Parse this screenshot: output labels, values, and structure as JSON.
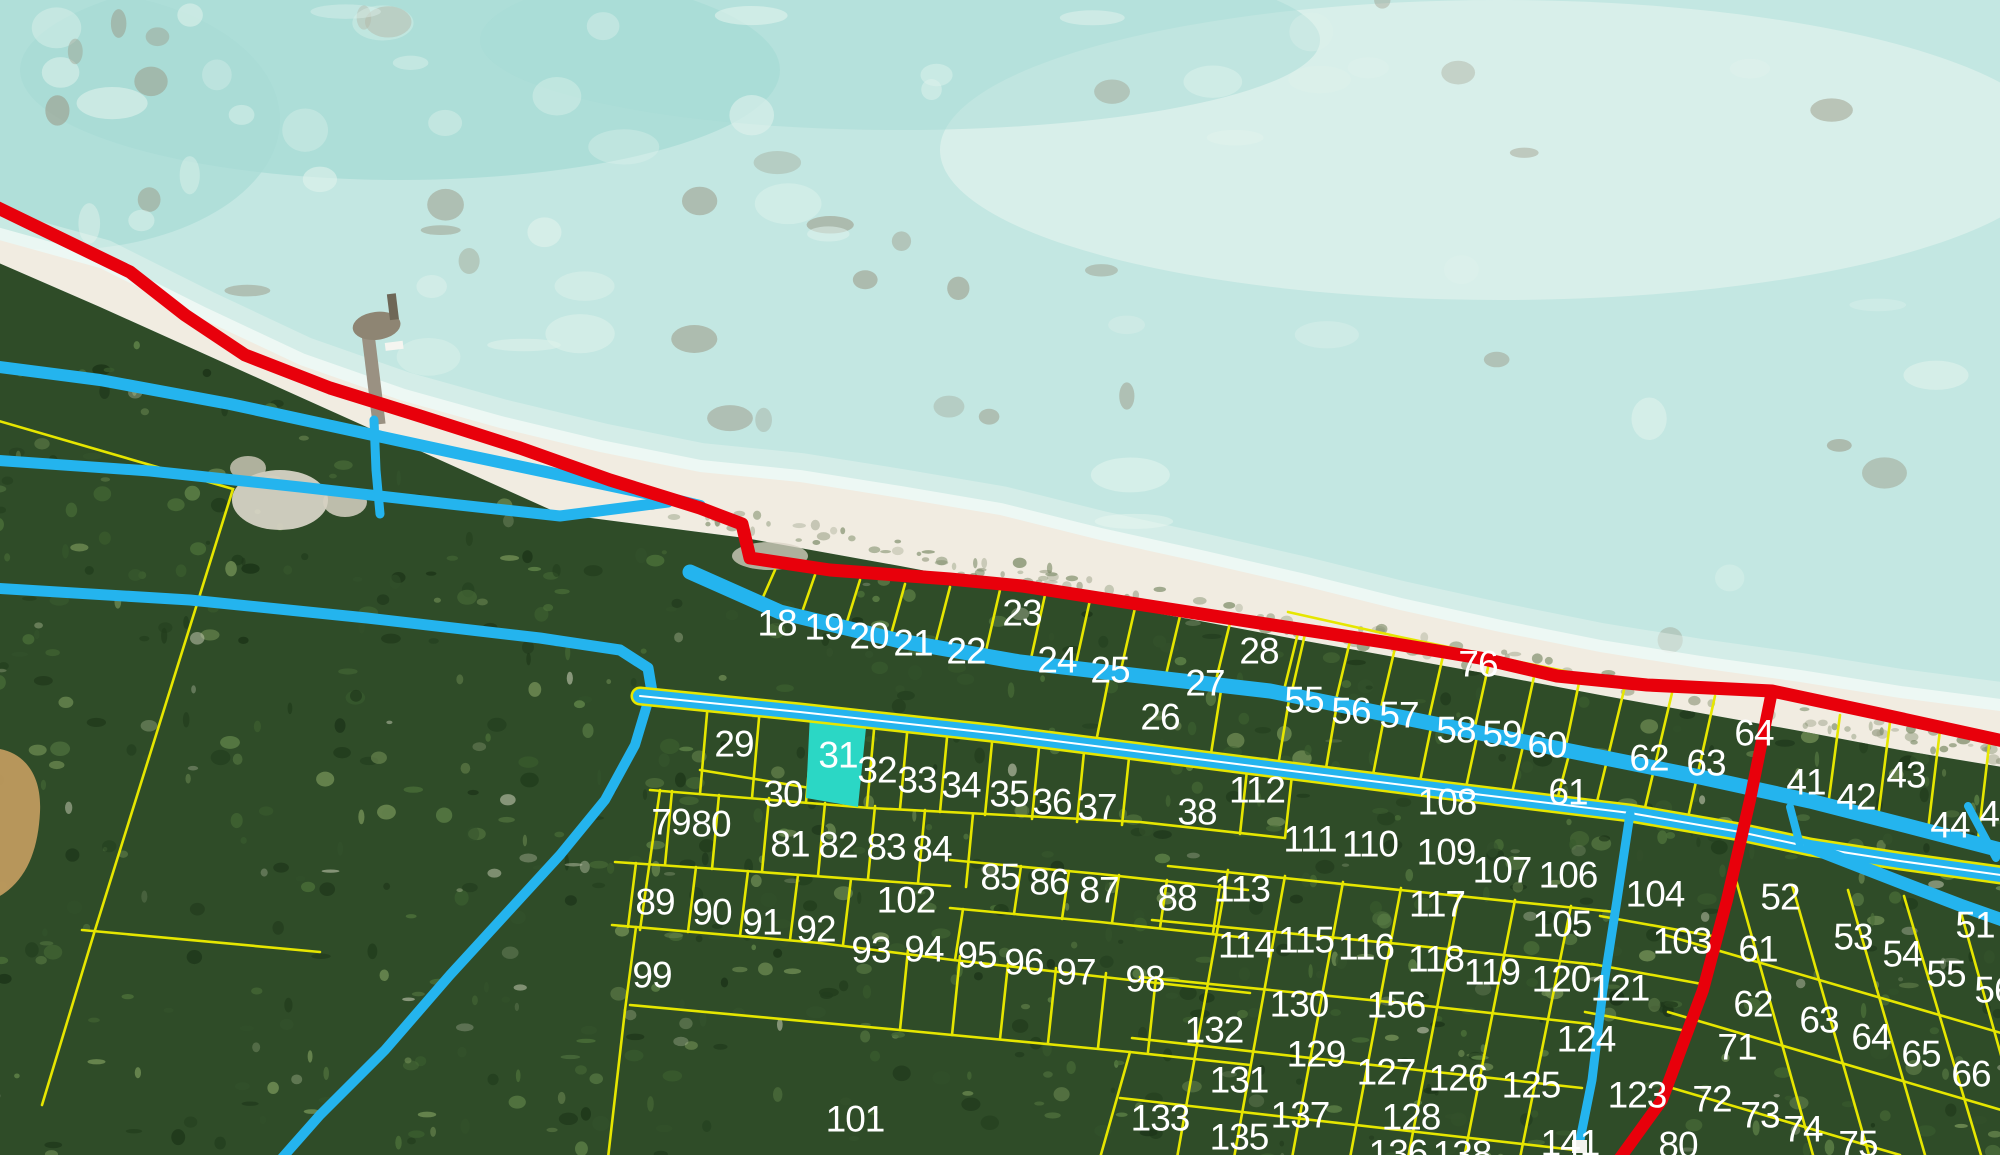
{
  "map": {
    "type": "aerial-parcel-cadastral-map",
    "colors": {
      "water": "#c3e7e2",
      "water_deep": "#a8dcd6",
      "water_light": "#e9f5f1",
      "sand": "#f1ece1",
      "land": "#2f4c28",
      "pond": "#bf9a5e",
      "road_red": "#e8000b",
      "road_cyan": "#24b4ee",
      "parcel_line_yellow": "#e6e600",
      "road_centerline": "#ffffff",
      "label_text": "#ffffff",
      "highlight_fill": "#2bd7c5"
    },
    "selected_parcel": {
      "label": "31",
      "points": "810,713 867,718 858,807 806,798"
    },
    "label_font_size": 37,
    "parcel_labels": [
      {
        "t": "18",
        "x": 777,
        "y": 622
      },
      {
        "t": "19",
        "x": 824,
        "y": 626
      },
      {
        "t": "20",
        "x": 869,
        "y": 635
      },
      {
        "t": "21",
        "x": 913,
        "y": 642
      },
      {
        "t": "22",
        "x": 966,
        "y": 650
      },
      {
        "t": "23",
        "x": 1022,
        "y": 612
      },
      {
        "t": "24",
        "x": 1057,
        "y": 659
      },
      {
        "t": "25",
        "x": 1110,
        "y": 669
      },
      {
        "t": "26",
        "x": 1160,
        "y": 716
      },
      {
        "t": "27",
        "x": 1205,
        "y": 682
      },
      {
        "t": "28",
        "x": 1259,
        "y": 650
      },
      {
        "t": "76",
        "x": 1478,
        "y": 663
      },
      {
        "t": "55",
        "x": 1304,
        "y": 699
      },
      {
        "t": "56",
        "x": 1351,
        "y": 710
      },
      {
        "t": "57",
        "x": 1399,
        "y": 714
      },
      {
        "t": "58",
        "x": 1456,
        "y": 729
      },
      {
        "t": "59",
        "x": 1502,
        "y": 733
      },
      {
        "t": "60",
        "x": 1547,
        "y": 744
      },
      {
        "t": "61",
        "x": 1568,
        "y": 791
      },
      {
        "t": "62",
        "x": 1649,
        "y": 757
      },
      {
        "t": "63",
        "x": 1706,
        "y": 762
      },
      {
        "t": "64",
        "x": 1754,
        "y": 732
      },
      {
        "t": "41",
        "x": 1806,
        "y": 781
      },
      {
        "t": "42",
        "x": 1856,
        "y": 796
      },
      {
        "t": "43",
        "x": 1906,
        "y": 774
      },
      {
        "t": "44",
        "x": 1950,
        "y": 824
      },
      {
        "t": "45",
        "x": 1999,
        "y": 813
      },
      {
        "t": "29",
        "x": 734,
        "y": 743
      },
      {
        "t": "30",
        "x": 783,
        "y": 793
      },
      {
        "t": "31",
        "x": 838,
        "y": 754
      },
      {
        "t": "32",
        "x": 877,
        "y": 769
      },
      {
        "t": "33",
        "x": 917,
        "y": 779
      },
      {
        "t": "34",
        "x": 961,
        "y": 784
      },
      {
        "t": "35",
        "x": 1009,
        "y": 793
      },
      {
        "t": "36",
        "x": 1052,
        "y": 801
      },
      {
        "t": "37",
        "x": 1097,
        "y": 806
      },
      {
        "t": "38",
        "x": 1197,
        "y": 811
      },
      {
        "t": "112",
        "x": 1257,
        "y": 789
      },
      {
        "t": "108",
        "x": 1447,
        "y": 801
      },
      {
        "t": "79",
        "x": 671,
        "y": 821
      },
      {
        "t": "80",
        "x": 711,
        "y": 823
      },
      {
        "t": "81",
        "x": 790,
        "y": 843
      },
      {
        "t": "82",
        "x": 838,
        "y": 844
      },
      {
        "t": "83",
        "x": 886,
        "y": 846
      },
      {
        "t": "84",
        "x": 932,
        "y": 848
      },
      {
        "t": "85",
        "x": 1000,
        "y": 876
      },
      {
        "t": "86",
        "x": 1049,
        "y": 881
      },
      {
        "t": "87",
        "x": 1099,
        "y": 889
      },
      {
        "t": "88",
        "x": 1177,
        "y": 897
      },
      {
        "t": "111",
        "x": 1310,
        "y": 838
      },
      {
        "t": "110",
        "x": 1370,
        "y": 843
      },
      {
        "t": "109",
        "x": 1446,
        "y": 851
      },
      {
        "t": "107",
        "x": 1502,
        "y": 869
      },
      {
        "t": "106",
        "x": 1568,
        "y": 874
      },
      {
        "t": "105",
        "x": 1562,
        "y": 923
      },
      {
        "t": "104",
        "x": 1655,
        "y": 893
      },
      {
        "t": "103",
        "x": 1682,
        "y": 940
      },
      {
        "t": "52",
        "x": 1780,
        "y": 896
      },
      {
        "t": "51",
        "x": 1975,
        "y": 924
      },
      {
        "t": "53",
        "x": 1853,
        "y": 936
      },
      {
        "t": "54",
        "x": 1902,
        "y": 953
      },
      {
        "t": "55",
        "x": 1946,
        "y": 973
      },
      {
        "t": "56",
        "x": 1994,
        "y": 989
      },
      {
        "t": "61",
        "x": 1758,
        "y": 948
      },
      {
        "t": "89",
        "x": 655,
        "y": 901
      },
      {
        "t": "90",
        "x": 712,
        "y": 911
      },
      {
        "t": "91",
        "x": 762,
        "y": 921
      },
      {
        "t": "92",
        "x": 816,
        "y": 928
      },
      {
        "t": "102",
        "x": 906,
        "y": 899
      },
      {
        "t": "93",
        "x": 871,
        "y": 949
      },
      {
        "t": "94",
        "x": 924,
        "y": 948
      },
      {
        "t": "95",
        "x": 977,
        "y": 954
      },
      {
        "t": "96",
        "x": 1024,
        "y": 961
      },
      {
        "t": "97",
        "x": 1076,
        "y": 971
      },
      {
        "t": "98",
        "x": 1145,
        "y": 978
      },
      {
        "t": "99",
        "x": 652,
        "y": 974
      },
      {
        "t": "113",
        "x": 1242,
        "y": 888
      },
      {
        "t": "114",
        "x": 1246,
        "y": 944
      },
      {
        "t": "115",
        "x": 1306,
        "y": 939
      },
      {
        "t": "116",
        "x": 1366,
        "y": 946
      },
      {
        "t": "117",
        "x": 1437,
        "y": 903
      },
      {
        "t": "118",
        "x": 1436,
        "y": 958
      },
      {
        "t": "119",
        "x": 1492,
        "y": 971
      },
      {
        "t": "120",
        "x": 1561,
        "y": 978
      },
      {
        "t": "121",
        "x": 1620,
        "y": 987
      },
      {
        "t": "130",
        "x": 1299,
        "y": 1003
      },
      {
        "t": "156",
        "x": 1396,
        "y": 1004
      },
      {
        "t": "132",
        "x": 1214,
        "y": 1029
      },
      {
        "t": "131",
        "x": 1239,
        "y": 1079
      },
      {
        "t": "129",
        "x": 1316,
        "y": 1053
      },
      {
        "t": "127",
        "x": 1386,
        "y": 1071
      },
      {
        "t": "126",
        "x": 1458,
        "y": 1077
      },
      {
        "t": "125",
        "x": 1531,
        "y": 1084
      },
      {
        "t": "124",
        "x": 1586,
        "y": 1038
      },
      {
        "t": "123",
        "x": 1637,
        "y": 1094
      },
      {
        "t": "128",
        "x": 1411,
        "y": 1116
      },
      {
        "t": "137",
        "x": 1300,
        "y": 1114
      },
      {
        "t": "135",
        "x": 1239,
        "y": 1136
      },
      {
        "t": "133",
        "x": 1160,
        "y": 1117
      },
      {
        "t": "101",
        "x": 855,
        "y": 1118
      },
      {
        "t": "141",
        "x": 1570,
        "y": 1142
      },
      {
        "t": "136",
        "x": 1398,
        "y": 1152
      },
      {
        "t": "138",
        "x": 1462,
        "y": 1153
      },
      {
        "t": "62",
        "x": 1753,
        "y": 1003
      },
      {
        "t": "63",
        "x": 1819,
        "y": 1019
      },
      {
        "t": "64",
        "x": 1871,
        "y": 1036
      },
      {
        "t": "65",
        "x": 1921,
        "y": 1053
      },
      {
        "t": "66",
        "x": 1971,
        "y": 1073
      },
      {
        "t": "71",
        "x": 1737,
        "y": 1046
      },
      {
        "t": "72",
        "x": 1712,
        "y": 1098
      },
      {
        "t": "73",
        "x": 1760,
        "y": 1114
      },
      {
        "t": "74",
        "x": 1803,
        "y": 1128
      },
      {
        "t": "75",
        "x": 1858,
        "y": 1143
      },
      {
        "t": "80",
        "x": 1678,
        "y": 1144
      }
    ]
  }
}
